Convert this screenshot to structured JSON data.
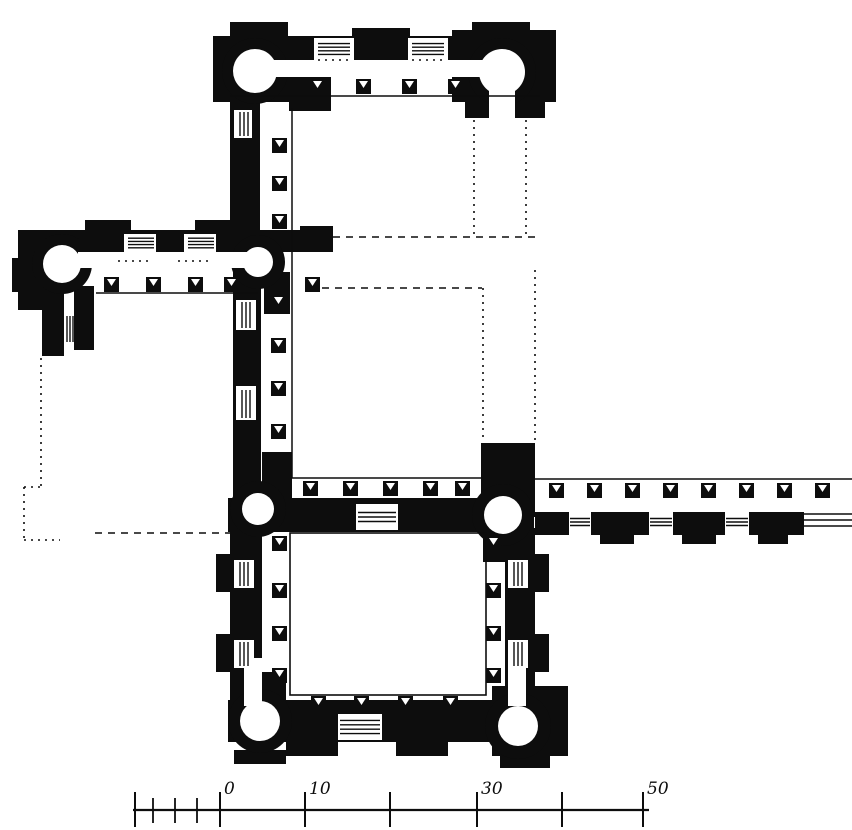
{
  "meta": {
    "figure_type": "architectural-floor-plan",
    "ink_color": "#0d0d0d",
    "paper_color": "#ffffff",
    "canvas": {
      "width": 852,
      "height": 830
    }
  },
  "scale_bar": {
    "baseline": {
      "x1": 133,
      "y": 810,
      "x2": 649
    },
    "labels": [
      "0",
      "10",
      "30",
      "50"
    ],
    "ticks": [
      {
        "x": 135,
        "major": true
      },
      {
        "x": 153,
        "major": false
      },
      {
        "x": 175,
        "major": false
      },
      {
        "x": 197,
        "major": false
      },
      {
        "x": 220,
        "major": true,
        "label": "0"
      },
      {
        "x": 305,
        "major": true,
        "label": "10"
      },
      {
        "x": 390,
        "major": true
      },
      {
        "x": 477,
        "major": true,
        "label": "30"
      },
      {
        "x": 562,
        "major": true
      },
      {
        "x": 643,
        "major": true,
        "label": "50"
      }
    ]
  },
  "plan": {
    "walls": [
      {
        "name": "north-wing-outer-wall",
        "x": 213,
        "y": 36,
        "w": 326,
        "h": 28
      },
      {
        "name": "north-wing-pavilion-left",
        "x": 230,
        "y": 22,
        "w": 58,
        "h": 20
      },
      {
        "name": "north-wing-pavilion-center",
        "x": 352,
        "y": 28,
        "w": 58,
        "h": 14
      },
      {
        "name": "north-wing-pavilion-right",
        "x": 472,
        "y": 22,
        "w": 58,
        "h": 20
      },
      {
        "name": "north-wing-tower-block-west",
        "x": 213,
        "y": 36,
        "w": 76,
        "h": 66
      },
      {
        "name": "north-wing-tower-block-east",
        "x": 452,
        "y": 30,
        "w": 104,
        "h": 72
      },
      {
        "name": "north-wing-inner-stub-west",
        "x": 289,
        "y": 77,
        "w": 42,
        "h": 34
      },
      {
        "name": "north-wing-inner-stub-east",
        "x": 462,
        "y": 77,
        "w": 42,
        "h": 24
      },
      {
        "name": "north-east-tower-base",
        "x": 465,
        "y": 96,
        "w": 80,
        "h": 22
      },
      {
        "name": "west-connector-wall",
        "x": 230,
        "y": 96,
        "w": 30,
        "h": 140
      },
      {
        "name": "west-wing-outer-wall",
        "x": 18,
        "y": 230,
        "w": 315,
        "h": 22
      },
      {
        "name": "west-wing-pavilion-1",
        "x": 85,
        "y": 220,
        "w": 46,
        "h": 12
      },
      {
        "name": "west-wing-pavilion-2",
        "x": 195,
        "y": 220,
        "w": 46,
        "h": 12
      },
      {
        "name": "west-wing-pavilion-3",
        "x": 300,
        "y": 226,
        "w": 33,
        "h": 12
      },
      {
        "name": "west-wing-end-block",
        "x": 18,
        "y": 230,
        "w": 30,
        "h": 80
      },
      {
        "name": "west-wing-end-bump",
        "x": 12,
        "y": 258,
        "w": 12,
        "h": 34
      },
      {
        "name": "west-wing-south-stub-a",
        "x": 42,
        "y": 286,
        "w": 22,
        "h": 70
      },
      {
        "name": "west-wing-south-stub-b",
        "x": 74,
        "y": 286,
        "w": 20,
        "h": 64
      },
      {
        "name": "court-west-wall",
        "x": 233,
        "y": 250,
        "w": 28,
        "h": 262
      },
      {
        "name": "court-west-corner-mass",
        "x": 262,
        "y": 452,
        "w": 30,
        "h": 58
      },
      {
        "name": "court-north-corner-mass",
        "x": 264,
        "y": 272,
        "w": 26,
        "h": 42
      },
      {
        "name": "court-south-wall",
        "x": 228,
        "y": 498,
        "w": 306,
        "h": 34
      },
      {
        "name": "court-se-connector",
        "x": 481,
        "y": 443,
        "w": 54,
        "h": 74
      },
      {
        "name": "lower-court-west-wall",
        "x": 230,
        "y": 528,
        "w": 32,
        "h": 178
      },
      {
        "name": "lower-court-west-jamb",
        "x": 262,
        "y": 672,
        "w": 24,
        "h": 34
      },
      {
        "name": "lower-court-west-pavilion-1",
        "x": 216,
        "y": 554,
        "w": 16,
        "h": 38
      },
      {
        "name": "lower-court-west-pavilion-2",
        "x": 216,
        "y": 634,
        "w": 16,
        "h": 38
      },
      {
        "name": "lower-court-east-wall",
        "x": 505,
        "y": 528,
        "w": 30,
        "h": 178
      },
      {
        "name": "lower-court-east-pavilion-1",
        "x": 533,
        "y": 554,
        "w": 16,
        "h": 38
      },
      {
        "name": "lower-court-east-pavilion-2",
        "x": 533,
        "y": 634,
        "w": 16,
        "h": 38
      },
      {
        "name": "lower-court-ne-jamb",
        "x": 483,
        "y": 528,
        "w": 30,
        "h": 34
      },
      {
        "name": "lower-court-south-wall",
        "x": 228,
        "y": 700,
        "w": 304,
        "h": 42
      },
      {
        "name": "lower-court-south-bump-1",
        "x": 286,
        "y": 742,
        "w": 52,
        "h": 14
      },
      {
        "name": "lower-court-south-bump-2",
        "x": 396,
        "y": 742,
        "w": 52,
        "h": 14
      },
      {
        "name": "sw-tower-bump",
        "x": 234,
        "y": 750,
        "w": 52,
        "h": 14
      },
      {
        "name": "se-corner-block",
        "x": 492,
        "y": 686,
        "w": 76,
        "h": 70
      },
      {
        "name": "se-corner-bump",
        "x": 500,
        "y": 756,
        "w": 50,
        "h": 12
      },
      {
        "name": "gallery-south-wall-1",
        "x": 535,
        "y": 512,
        "w": 34,
        "h": 23
      },
      {
        "name": "gallery-south-wall-2",
        "x": 591,
        "y": 512,
        "w": 58,
        "h": 23
      },
      {
        "name": "gallery-south-wall-3",
        "x": 673,
        "y": 512,
        "w": 52,
        "h": 23
      },
      {
        "name": "gallery-south-wall-4",
        "x": 749,
        "y": 512,
        "w": 55,
        "h": 23
      },
      {
        "name": "gallery-bump-1",
        "x": 600,
        "y": 535,
        "w": 34,
        "h": 9
      },
      {
        "name": "gallery-bump-2",
        "x": 682,
        "y": 535,
        "w": 34,
        "h": 9
      },
      {
        "name": "gallery-bump-3",
        "x": 758,
        "y": 535,
        "w": 30,
        "h": 9
      }
    ],
    "towers": [
      {
        "name": "round-tower-north-west",
        "cx": 255,
        "cy": 71,
        "ro": 33,
        "ri": 22
      },
      {
        "name": "round-tower-north-east",
        "cx": 502,
        "cy": 72,
        "ro": 34,
        "ri": 23
      },
      {
        "name": "round-tower-west-wing",
        "cx": 62,
        "cy": 264,
        "ro": 30,
        "ri": 19
      },
      {
        "name": "round-tower-court-junction",
        "cx": 258,
        "cy": 262,
        "ro": 27,
        "ri": 15
      },
      {
        "name": "round-tower-court-sw",
        "cx": 258,
        "cy": 509,
        "ro": 28,
        "ri": 16
      },
      {
        "name": "round-tower-court-se",
        "cx": 503,
        "cy": 515,
        "ro": 31,
        "ri": 19
      },
      {
        "name": "round-tower-south-west",
        "cx": 260,
        "cy": 721,
        "ro": 32,
        "ri": 20
      },
      {
        "name": "round-tower-south-east",
        "cx": 518,
        "cy": 726,
        "ro": 33,
        "ri": 20
      }
    ],
    "white_areas": [
      {
        "name": "north-corridor",
        "x": 268,
        "y": 60,
        "w": 216,
        "h": 17
      },
      {
        "name": "west-corridor",
        "x": 78,
        "y": 252,
        "w": 184,
        "h": 16
      },
      {
        "name": "ne-tower-neck",
        "x": 489,
        "y": 72,
        "w": 26,
        "h": 47
      },
      {
        "name": "bay-north-1",
        "x": 314,
        "y": 38,
        "w": 40,
        "h": 24
      },
      {
        "name": "bay-north-2",
        "x": 408,
        "y": 38,
        "w": 40,
        "h": 24
      },
      {
        "name": "bay-west-1",
        "x": 124,
        "y": 234,
        "w": 32,
        "h": 18
      },
      {
        "name": "bay-west-2",
        "x": 184,
        "y": 234,
        "w": 32,
        "h": 18
      },
      {
        "name": "bay-connector",
        "x": 234,
        "y": 110,
        "w": 18,
        "h": 28
      },
      {
        "name": "bay-court-west-1",
        "x": 236,
        "y": 300,
        "w": 20,
        "h": 30
      },
      {
        "name": "bay-court-west-2",
        "x": 236,
        "y": 386,
        "w": 20,
        "h": 34
      },
      {
        "name": "court-south-entrance",
        "x": 356,
        "y": 504,
        "w": 42,
        "h": 26
      },
      {
        "name": "bay-lower-west-1",
        "x": 234,
        "y": 560,
        "w": 20,
        "h": 28
      },
      {
        "name": "bay-lower-west-2",
        "x": 234,
        "y": 640,
        "w": 20,
        "h": 28
      },
      {
        "name": "bay-lower-east-1",
        "x": 508,
        "y": 560,
        "w": 20,
        "h": 28
      },
      {
        "name": "bay-lower-east-2",
        "x": 508,
        "y": 640,
        "w": 20,
        "h": 28
      },
      {
        "name": "lower-south-entrance",
        "x": 338,
        "y": 714,
        "w": 44,
        "h": 26
      },
      {
        "name": "sw-tower-neck",
        "x": 244,
        "y": 658,
        "w": 18,
        "h": 48
      },
      {
        "name": "se-tower-neck",
        "x": 508,
        "y": 656,
        "w": 18,
        "h": 50
      }
    ],
    "solid_lines": [
      {
        "name": "north-inner-face",
        "x1": 230,
        "y1": 96,
        "x2": 540,
        "y2": 96
      },
      {
        "name": "west-inner-face",
        "x1": 96,
        "y1": 293,
        "x2": 258,
        "y2": 293
      },
      {
        "name": "court-west-edge",
        "x1": 292,
        "y1": 108,
        "x2": 292,
        "y2": 478
      },
      {
        "name": "court-south-edge",
        "x1": 292,
        "y1": 478,
        "x2": 483,
        "y2": 478
      },
      {
        "name": "gallery-north-face",
        "x1": 535,
        "y1": 479,
        "x2": 852,
        "y2": 479
      },
      {
        "name": "gallery-end-line-1",
        "x1": 804,
        "y1": 514,
        "x2": 852,
        "y2": 514
      },
      {
        "name": "gallery-end-line-2",
        "x1": 804,
        "y1": 520,
        "x2": 852,
        "y2": 520
      },
      {
        "name": "gallery-end-line-3",
        "x1": 804,
        "y1": 526,
        "x2": 852,
        "y2": 526
      }
    ],
    "dotted_lines": [
      {
        "name": "projected-upper-court-east-1",
        "x1": 474,
        "y1": 120,
        "x2": 474,
        "y2": 236,
        "style": "dot"
      },
      {
        "name": "projected-upper-court-east-2",
        "x1": 526,
        "y1": 120,
        "x2": 526,
        "y2": 236,
        "style": "dot"
      },
      {
        "name": "projected-upper-court-south",
        "x1": 333,
        "y1": 237,
        "x2": 537,
        "y2": 237,
        "style": "dash"
      },
      {
        "name": "projected-court-north",
        "x1": 322,
        "y1": 288,
        "x2": 482,
        "y2": 288,
        "style": "dash"
      },
      {
        "name": "projected-court-east-1",
        "x1": 483,
        "y1": 288,
        "x2": 483,
        "y2": 442,
        "style": "dot"
      },
      {
        "name": "projected-court-east-2",
        "x1": 535,
        "y1": 270,
        "x2": 535,
        "y2": 442,
        "style": "dot"
      },
      {
        "name": "projected-west-court-1",
        "x1": 41,
        "y1": 358,
        "x2": 41,
        "y2": 487,
        "style": "dot"
      },
      {
        "name": "projected-west-court-2",
        "x1": 24,
        "y1": 487,
        "x2": 41,
        "y2": 487,
        "style": "dot"
      },
      {
        "name": "projected-west-court-3",
        "x1": 24,
        "y1": 487,
        "x2": 24,
        "y2": 540,
        "style": "dot"
      },
      {
        "name": "projected-west-court-4",
        "x1": 24,
        "y1": 540,
        "x2": 60,
        "y2": 540,
        "style": "dot"
      },
      {
        "name": "projected-west-court-south",
        "x1": 95,
        "y1": 533,
        "x2": 230,
        "y2": 533,
        "style": "dash"
      },
      {
        "name": "threshold-dots-north-1",
        "x1": 318,
        "y1": 60,
        "x2": 350,
        "y2": 60,
        "style": "dot"
      },
      {
        "name": "threshold-dots-north-2",
        "x1": 412,
        "y1": 60,
        "x2": 444,
        "y2": 60,
        "style": "dot"
      },
      {
        "name": "threshold-dots-west-1",
        "x1": 118,
        "y1": 261,
        "x2": 152,
        "y2": 261,
        "style": "dot"
      },
      {
        "name": "threshold-dots-west-2",
        "x1": 178,
        "y1": 261,
        "x2": 212,
        "y2": 261,
        "style": "dot"
      },
      {
        "name": "threshold-dots-court-south",
        "x1": 358,
        "y1": 531,
        "x2": 396,
        "y2": 531,
        "style": "dot"
      }
    ],
    "outlines": [
      {
        "name": "lower-courtyard-edge",
        "x": 290,
        "y": 533,
        "w": 196,
        "h": 162
      }
    ],
    "steps": [
      {
        "name": "entrance-steps-north-1",
        "x": 318,
        "y": 40,
        "w": 32,
        "h": 18,
        "dir": "h",
        "n": 4
      },
      {
        "name": "entrance-steps-north-2",
        "x": 412,
        "y": 40,
        "w": 32,
        "h": 18,
        "dir": "h",
        "n": 4
      },
      {
        "name": "entrance-steps-west-1",
        "x": 128,
        "y": 235,
        "w": 26,
        "h": 16,
        "dir": "h",
        "n": 4
      },
      {
        "name": "entrance-steps-west-2",
        "x": 188,
        "y": 235,
        "w": 26,
        "h": 16,
        "dir": "h",
        "n": 4
      },
      {
        "name": "window-connector",
        "x": 236,
        "y": 112,
        "w": 16,
        "h": 24,
        "dir": "v",
        "n": 3
      },
      {
        "name": "window-court-west-1",
        "x": 238,
        "y": 302,
        "w": 16,
        "h": 26,
        "dir": "v",
        "n": 3
      },
      {
        "name": "window-court-west-2",
        "x": 238,
        "y": 390,
        "w": 16,
        "h": 28,
        "dir": "v",
        "n": 3
      },
      {
        "name": "window-west-stub",
        "x": 64,
        "y": 316,
        "w": 12,
        "h": 26,
        "dir": "v",
        "n": 3
      },
      {
        "name": "court-south-steps",
        "x": 358,
        "y": 508,
        "w": 38,
        "h": 18,
        "dir": "h",
        "n": 3
      },
      {
        "name": "gallery-steps-1",
        "x": 570,
        "y": 515,
        "w": 20,
        "h": 14,
        "dir": "h",
        "n": 3
      },
      {
        "name": "gallery-steps-2",
        "x": 650,
        "y": 515,
        "w": 22,
        "h": 14,
        "dir": "h",
        "n": 3
      },
      {
        "name": "gallery-steps-3",
        "x": 726,
        "y": 515,
        "w": 22,
        "h": 14,
        "dir": "h",
        "n": 3
      },
      {
        "name": "window-lower-west-1",
        "x": 236,
        "y": 562,
        "w": 16,
        "h": 24,
        "dir": "v",
        "n": 3
      },
      {
        "name": "window-lower-west-2",
        "x": 236,
        "y": 642,
        "w": 16,
        "h": 24,
        "dir": "v",
        "n": 3
      },
      {
        "name": "window-lower-east-1",
        "x": 510,
        "y": 562,
        "w": 16,
        "h": 24,
        "dir": "v",
        "n": 3
      },
      {
        "name": "window-lower-east-2",
        "x": 510,
        "y": 642,
        "w": 16,
        "h": 24,
        "dir": "v",
        "n": 3
      },
      {
        "name": "lower-south-steps",
        "x": 340,
        "y": 716,
        "w": 40,
        "h": 22,
        "dir": "h",
        "n": 4
      }
    ],
    "piers": {
      "size": 15,
      "items": [
        [
          310,
          79
        ],
        [
          356,
          79
        ],
        [
          402,
          79
        ],
        [
          448,
          79
        ],
        [
          272,
          138
        ],
        [
          272,
          176
        ],
        [
          272,
          214
        ],
        [
          104,
          277
        ],
        [
          146,
          277
        ],
        [
          188,
          277
        ],
        [
          224,
          277
        ],
        [
          305,
          277
        ],
        [
          271,
          295
        ],
        [
          271,
          338
        ],
        [
          271,
          381
        ],
        [
          271,
          424
        ],
        [
          303,
          481
        ],
        [
          343,
          481
        ],
        [
          383,
          481
        ],
        [
          423,
          481
        ],
        [
          455,
          481
        ],
        [
          549,
          483
        ],
        [
          587,
          483
        ],
        [
          625,
          483
        ],
        [
          663,
          483
        ],
        [
          701,
          483
        ],
        [
          739,
          483
        ],
        [
          777,
          483
        ],
        [
          815,
          483
        ],
        [
          272,
          536
        ],
        [
          272,
          583
        ],
        [
          272,
          626
        ],
        [
          272,
          668
        ],
        [
          486,
          536
        ],
        [
          486,
          583
        ],
        [
          486,
          626
        ],
        [
          486,
          668
        ],
        [
          311,
          696
        ],
        [
          354,
          696
        ],
        [
          398,
          696
        ],
        [
          443,
          696
        ]
      ]
    }
  }
}
